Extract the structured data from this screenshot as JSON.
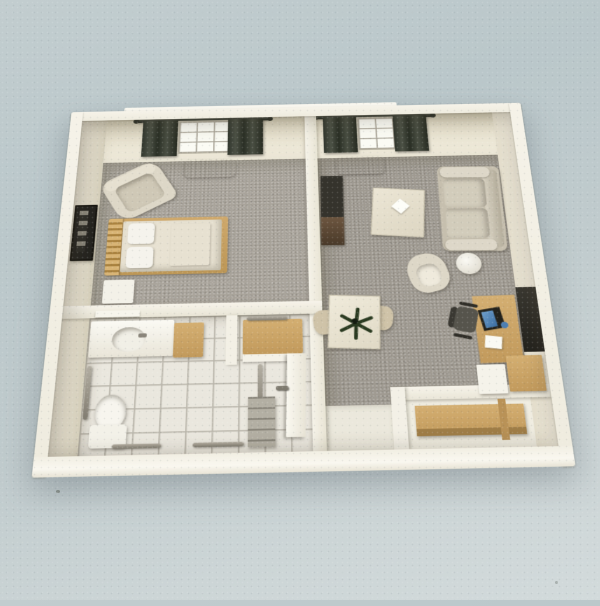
{
  "scene": {
    "type": "3d-floor-plan-render",
    "description": "Scanned 3D architectural rendering of a one-bedroom apartment floor plan viewed from above, on a pale blue-grey paper background",
    "rooms": [
      {
        "id": "bedroom",
        "label": "Bedroom",
        "floor": "grey carpet",
        "furniture": [
          "single bed with wooden frame",
          "two pillows",
          "folded blanket",
          "nightstand",
          "armchair",
          "wall picture frame",
          "window with dark curtains",
          "radiator"
        ]
      },
      {
        "id": "living-room",
        "label": "Living room",
        "floor": "grey carpet",
        "furniture": [
          "sofa",
          "coffee table with napkin",
          "swivel armchair",
          "round side table",
          "tv cabinet",
          "dining table with plant",
          "two dining chairs",
          "desk with computer monitor",
          "office chair",
          "wall board",
          "white cabinet",
          "wooden cabinet",
          "window with dark curtains",
          "radiator",
          "entry vinyl floor"
        ]
      },
      {
        "id": "bathroom",
        "label": "Bathroom",
        "floor": "white tile",
        "furniture": [
          "vanity sink",
          "toilet",
          "grab bars",
          "grey shelf steps",
          "wall shelf"
        ]
      },
      {
        "id": "hall-closet",
        "label": "Hall closet",
        "floor": "white tile",
        "furniture": [
          "wooden shelf",
          "door with handle"
        ]
      },
      {
        "id": "entry-alcove",
        "label": "Counter alcove",
        "floor": "light vinyl",
        "furniture": [
          "wooden counter"
        ]
      }
    ]
  },
  "labels": {
    "plan": "3D floor plan rendering",
    "bedroom": "Bedroom",
    "living": "Living room",
    "bathroom": "Bathroom",
    "hall": "Hall closet",
    "alcove": "Counter alcove",
    "bed": "Single bed",
    "pillow": "Pillow",
    "blanket": "Folded blanket",
    "nightstand": "Nightstand",
    "bedroomChair": "Bedroom armchair",
    "frame": "Wall picture frame",
    "window": "Window with curtains",
    "curtain": "Curtain panel",
    "rod": "Curtain rod",
    "radiator": "Radiator",
    "tvUnit": "TV cabinet",
    "coffeeTable": "Coffee table",
    "napkin": "Table napkin",
    "sofa": "Sofa",
    "sideTable": "Round side table",
    "armchair": "Swivel armchair",
    "diningTable": "Dining table",
    "plant": "Table plant",
    "diningChair": "Dining chair",
    "desk": "Desk",
    "monitor": "Computer monitor",
    "papers": "Papers",
    "cup": "Blue cup",
    "officeChair": "Office chair",
    "wallBoard": "Wall board",
    "cabinetWhite": "White cabinet",
    "cabinetWood": "Wooden cabinet",
    "counter": "Wooden counter",
    "vanity": "Vanity sink",
    "basin": "Sink basin",
    "faucet": "Faucet",
    "wallShelf": "Wall shelf",
    "closetShelf": "Closet shelf",
    "toilet": "Toilet",
    "grabBar": "Grab bar",
    "steps": "Grey shelf steps",
    "door": "Door",
    "doorHandle": "Door handle",
    "wall": "Wall",
    "partition": "Partition wall"
  },
  "palette": {
    "wall": "#f6f3e9",
    "wallFace": "#ece7d6",
    "wallFaceDark": "#ddd6c0",
    "carpet": "#a9a49b",
    "carpet2": "#9f9a91",
    "tile": "#eae7de",
    "grout": "#b9b5aa",
    "wood": "#c29a5c",
    "woodLight": "#d4af72",
    "cream": "#ddd7c7",
    "creamLight": "#e8e2d2",
    "entry": "#ebe8dc",
    "metal": "#8f8a80",
    "blue": "#4d7fb2",
    "dark": "#35332c",
    "plantGreen": "#2a3a20",
    "bgTop": "#c2cdcf",
    "bgBottom": "#d2dadb"
  }
}
